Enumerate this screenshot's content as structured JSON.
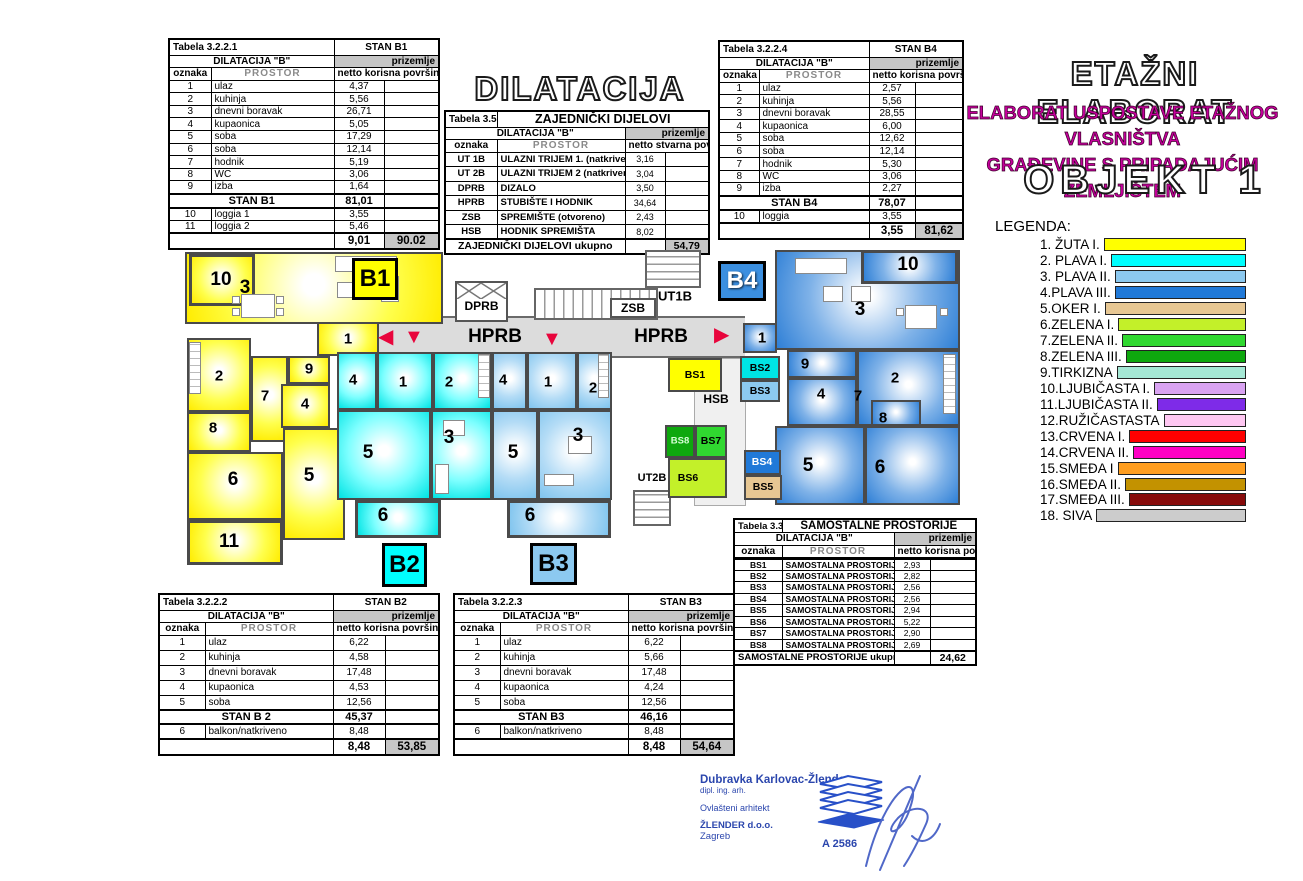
{
  "titles": {
    "dilatacija_big": "DILATACIJA \"B\"",
    "etazni": "ETAŽNI ELABORAT",
    "sub1": "ELABORAT USPOSTAVE ETAŽNOG VLASNIŠTVA",
    "sub2": "GRAĐEVINE S PRIPADAJUĆIM ZEMLJIŠTEM",
    "objekt": "OBJEKT 1",
    "legenda": "LEGENDA:"
  },
  "legend": {
    "items": [
      {
        "label": "1. ŽUTA  I.",
        "color": "#FFFF00"
      },
      {
        "label": "2. PLAVA I.",
        "color": "#00FFFF"
      },
      {
        "label": "3. PLAVA II.",
        "color": "#8CC9F0"
      },
      {
        "label": "4.PLAVA III.",
        "color": "#2079D8"
      },
      {
        "label": "5.OKER  I.",
        "color": "#E7C793"
      },
      {
        "label": "6.ZELENA I.",
        "color": "#C3F029"
      },
      {
        "label": "7.ZELENA II.",
        "color": "#30D830"
      },
      {
        "label": "8.ZELENA III.",
        "color": "#0EA80E"
      },
      {
        "label": "9.TIRKIZNA",
        "color": "#A5E8D5"
      },
      {
        "label": "10.LJUBIČASTA I.",
        "color": "#D9A3F2"
      },
      {
        "label": "11.LJUBIČASTA II.",
        "color": "#7E2BE8"
      },
      {
        "label": "12.RUŽIČASTASTA",
        "color": "#FFC7F2"
      },
      {
        "label": "13.CRVENA I.",
        "color": "#FF0000"
      },
      {
        "label": "14.CRVENA II.",
        "color": "#FF00C4"
      },
      {
        "label": "15.SMEĐA I",
        "color": "#FF9E1F"
      },
      {
        "label": "16.SMEĐA II.",
        "color": "#C39200"
      },
      {
        "label": "17.SMEĐA III.",
        "color": "#870B0B"
      },
      {
        "label": "18. SIVA",
        "color": "#CCCCCC"
      }
    ]
  },
  "tables": {
    "b1": {
      "tabela": "Tabela 3.2.2.1",
      "stan": "STAN B1",
      "dilatacija": "DILATACIJA  \"B\"",
      "floor": "prizemlje",
      "col_oznaka": "oznaka",
      "col_prostor": "PROSTOR",
      "col_area": "netto korisna površina",
      "rows": [
        [
          "1",
          "ulaz",
          "4,37"
        ],
        [
          "2",
          "kuhinja",
          "5,56"
        ],
        [
          "3",
          "dnevni boravak",
          "26,71"
        ],
        [
          "4",
          "kupaonica",
          "5,05"
        ],
        [
          "5",
          "soba",
          "17,29"
        ],
        [
          "6",
          "soba",
          "12,14"
        ],
        [
          "7",
          "hodnik",
          "5,19"
        ],
        [
          "8",
          "WC",
          "3,06"
        ],
        [
          "9",
          "izba",
          "1,64"
        ]
      ],
      "subtotal_label": "STAN B1",
      "subtotal_value": "81,01",
      "extra": [
        [
          "10",
          "loggia 1",
          "3,55"
        ],
        [
          "11",
          "loggia 2",
          "5,46"
        ]
      ],
      "total_value": "9,01",
      "grand_total": "90.02"
    },
    "b2": {
      "tabela": "Tabela 3.2.2.2",
      "stan": "STAN B2",
      "dilatacija": "DILATACIJA  \"B\"",
      "floor": "prizemlje",
      "col_oznaka": "oznaka",
      "col_prostor": "PROSTOR",
      "col_area": "netto korisna površina",
      "rows": [
        [
          "1",
          "ulaz",
          "6,22"
        ],
        [
          "2",
          "kuhinja",
          "4,58"
        ],
        [
          "3",
          "dnevni boravak",
          "17,48"
        ],
        [
          "4",
          "kupaonica",
          "4,53"
        ],
        [
          "5",
          "soba",
          "12,56"
        ]
      ],
      "subtotal_label": "STAN B 2",
      "subtotal_value": "45,37",
      "extra": [
        [
          "6",
          "balkon/natkriveno",
          "8,48"
        ]
      ],
      "total_value": "8,48",
      "grand_total": "53,85"
    },
    "b3": {
      "tabela": "Tabela 3.2.2.3",
      "stan": "STAN B3",
      "dilatacija": "DILATACIJA  \"B\"",
      "floor": "prizemlje",
      "col_oznaka": "oznaka",
      "col_prostor": "PROSTOR",
      "col_area": "netto korisna površina",
      "rows": [
        [
          "1",
          "ulaz",
          "6,22"
        ],
        [
          "2",
          "kuhinja",
          "5,66"
        ],
        [
          "3",
          "dnevni boravak",
          "17,48"
        ],
        [
          "4",
          "kupaonica",
          "4,24"
        ],
        [
          "5",
          "soba",
          "12,56"
        ]
      ],
      "subtotal_label": "STAN B3",
      "subtotal_value": "46,16",
      "extra": [
        [
          "6",
          "balkon/natkriveno",
          "8,48"
        ]
      ],
      "total_value": "8,48",
      "grand_total": "54,64"
    },
    "b4": {
      "tabela": "Tabela 3.2.2.4",
      "stan": "STAN B4",
      "dilatacija": "DILATACIJA  \"B\"",
      "floor": "prizemlje",
      "col_oznaka": "oznaka",
      "col_prostor": "PROSTOR",
      "col_area": "netto korisna površina",
      "rows": [
        [
          "1",
          "ulaz",
          "2,57"
        ],
        [
          "2",
          "kuhinja",
          "5,56"
        ],
        [
          "3",
          "dnevni boravak",
          "28,55"
        ],
        [
          "4",
          "kupaonica",
          "6,00"
        ],
        [
          "5",
          "soba",
          "12,62"
        ],
        [
          "6",
          "soba",
          "12,14"
        ],
        [
          "7",
          "hodnik",
          "5,30"
        ],
        [
          "8",
          "WC",
          "3,06"
        ],
        [
          "9",
          "izba",
          "2,27"
        ]
      ],
      "subtotal_label": "STAN B4",
      "subtotal_value": "78,07",
      "extra": [
        [
          "10",
          "loggia",
          "3,55"
        ]
      ],
      "total_value": "3,55",
      "grand_total": "81,62"
    },
    "zajednicki": {
      "tabela": "Tabela 3.5.5.",
      "title": "ZAJEDNIČKI DIJELOVI",
      "dilatacija": "DILATACIJA \"B\"",
      "floor": "prizemlje",
      "col_oznaka": "oznaka",
      "col_prostor": "PROSTOR",
      "col_area": "netto stvarna površina",
      "rows": [
        [
          "UT 1B",
          "ULAZNI TRIJEM 1. (natkriveno)",
          "3,16"
        ],
        [
          "UT 2B",
          "ULAZNI TRIJEM 2 (natkriveno)",
          "3,04"
        ],
        [
          "DPRB",
          "DIZALO",
          "3,50"
        ],
        [
          "HPRB",
          "STUBIŠTE I HODNIK",
          "34,64"
        ],
        [
          "ZSB",
          "SPREMIŠTE (otvoreno)",
          "2,43"
        ],
        [
          "HSB",
          "HODNIK SPREMIŠTA",
          "8,02"
        ]
      ],
      "footer_label": "ZAJEDNIČKI DIJELOVI ukupno",
      "footer_total": "54,79"
    },
    "samostalne": {
      "tabela": "Tabela 3.3.",
      "title": "SAMOSTALNE PROSTORIJE",
      "dilatacija": "DILATACIJA  \"B\"",
      "floor": "prizemlje",
      "col_oznaka": "oznaka",
      "col_prostor": "PROSTOR",
      "col_area": "netto korisna površina",
      "rows": [
        [
          "BS1",
          "SAMOSTALNA PROSTORIJA 1",
          "2,93"
        ],
        [
          "BS2",
          "SAMOSTALNA PROSTORIJA 2",
          "2,82"
        ],
        [
          "BS3",
          "SAMOSTALNA PROSTORIJA 3",
          "2,56"
        ],
        [
          "BS4",
          "SAMOSTALNA PROSTORIJA 4",
          "2,56"
        ],
        [
          "BS5",
          "SAMOSTALNA PROSTORIJA 5",
          "2,94"
        ],
        [
          "BS6",
          "SAMOSTALNA PROSTORIJA 6",
          "5,22"
        ],
        [
          "BS7",
          "SAMOSTALNA PROSTORIJA 7",
          "2,90"
        ],
        [
          "BS8",
          "SAMOSTALNA PROSTORIJA 8",
          "2,69"
        ]
      ],
      "footer_label": "SAMOSTALNE PROSTORIJE ukupno",
      "footer_total": "24,62"
    }
  },
  "plan": {
    "badges": {
      "b1": "B1",
      "b2": "B2",
      "b3": "B3",
      "b4": "B4"
    },
    "labels": {
      "hprb_left": "HPRB",
      "hprb_right": "HPRB",
      "dprb": "DPRB",
      "zsb": "ZSB",
      "ut1b": "UT1B",
      "ut2b": "UT2B",
      "hsb": "HSB",
      "bs1": "BS1",
      "bs2": "BS2",
      "bs3": "BS3",
      "bs4": "BS4",
      "bs5": "BS5",
      "bs6": "BS6",
      "bs7": "BS7",
      "bs8": "BS8"
    },
    "rooms": {
      "b1": [
        "10",
        "3",
        "1",
        "2",
        "9",
        "7",
        "4",
        "8",
        "6",
        "5",
        "11"
      ],
      "b2": [
        "4",
        "1",
        "2",
        "5",
        "3",
        "6"
      ],
      "b3": [
        "4",
        "1",
        "2",
        "5",
        "3",
        "6"
      ],
      "b4": [
        "10",
        "3",
        "1",
        "9",
        "2",
        "4",
        "7",
        "8",
        "5",
        "6"
      ]
    },
    "icons": {
      "arrow_left": "◀",
      "arrow_down": "▼",
      "arrow_right": "▶"
    }
  },
  "colors": {
    "zuta": "#FFFF00",
    "plava1": "#00FFFF",
    "plava2": "#8CC9F0",
    "plava3": "#2079D8",
    "oker": "#E7C793",
    "zelena1": "#C3F029",
    "zelena2": "#30D830",
    "zelena3": "#0EA80E",
    "tirkizna": "#A5E8D5",
    "ljubicasta1": "#D9A3F2",
    "ljubicasta2": "#7E2BE8",
    "ruzicasta": "#FFC7F2",
    "crvena1": "#FF0000",
    "crvena2": "#FF00C4",
    "smedja1": "#FF9E1F",
    "smedja2": "#C39200",
    "smedja3": "#870B0B",
    "siva": "#CCCCCC",
    "table_gray": "#C6C6C6",
    "arrow_red": "#E8053C",
    "subtitle_magenta": "#C4009B",
    "signature_blue": "#2B46AD"
  },
  "signature": {
    "name": "Dubravka Karlovac-Žlender",
    "line2": "dipl. ing. arh.",
    "line3": "Ovlašteni arhitekt",
    "line4": "ŽLENDER d.o.o.",
    "line5": "Zagreb",
    "stamp": "A 2586"
  }
}
